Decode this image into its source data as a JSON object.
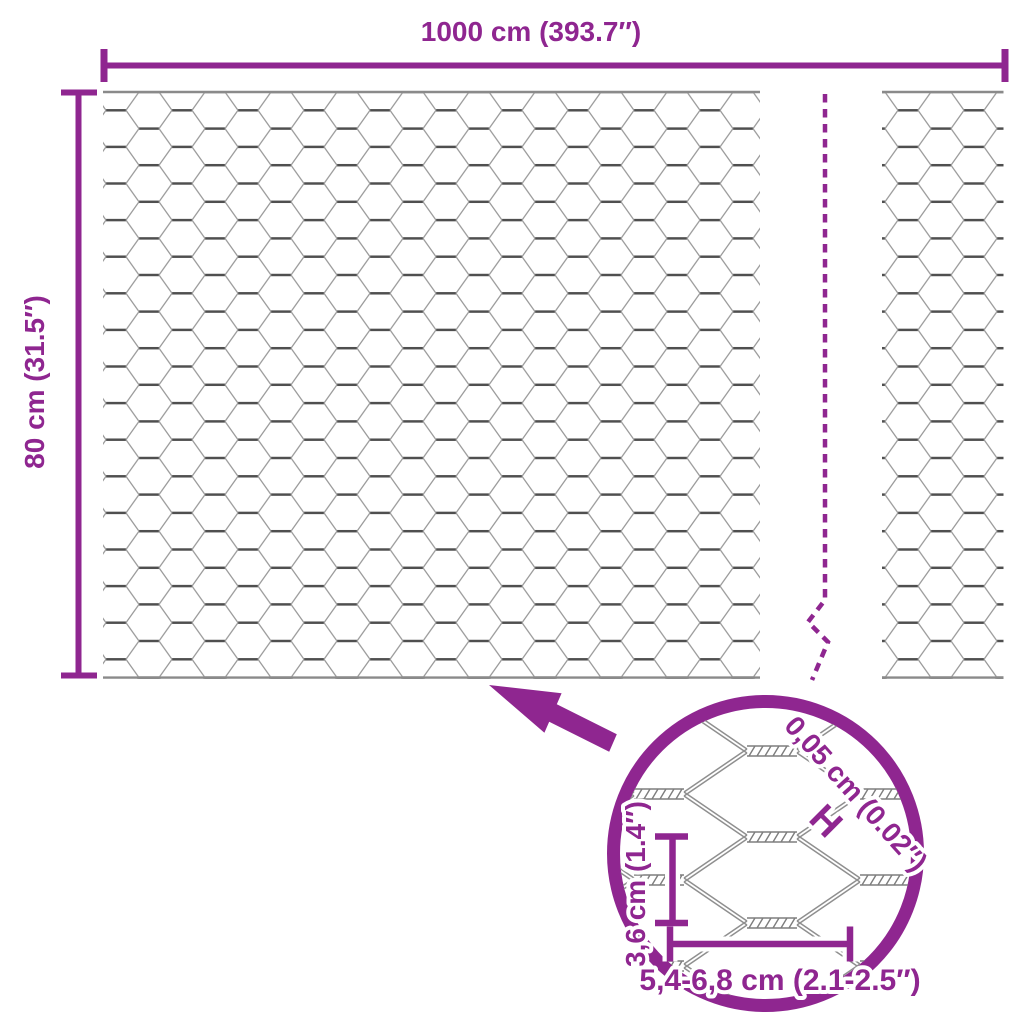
{
  "colors": {
    "accent": "#8F2690",
    "mesh_line": "#9b9b9b",
    "mesh_twist": "#4f4f4f",
    "mesh_border": "#8a8a8a",
    "magnified_line": "#8f8f8f",
    "magnified_rope": "#7d7d7d"
  },
  "dimensions": {
    "width": {
      "label": "1000 cm (393.7″)"
    },
    "height": {
      "label": "80 cm (31.5″)"
    }
  },
  "detail_view": {
    "wire_thickness": {
      "label": "0,05 cm (0.02″)",
      "symbol": "H"
    },
    "mesh_height": {
      "label": "3,6 cm (1.4″)"
    },
    "mesh_width": {
      "label": "5,4-6,8 cm (2.1-2.5″)"
    }
  }
}
